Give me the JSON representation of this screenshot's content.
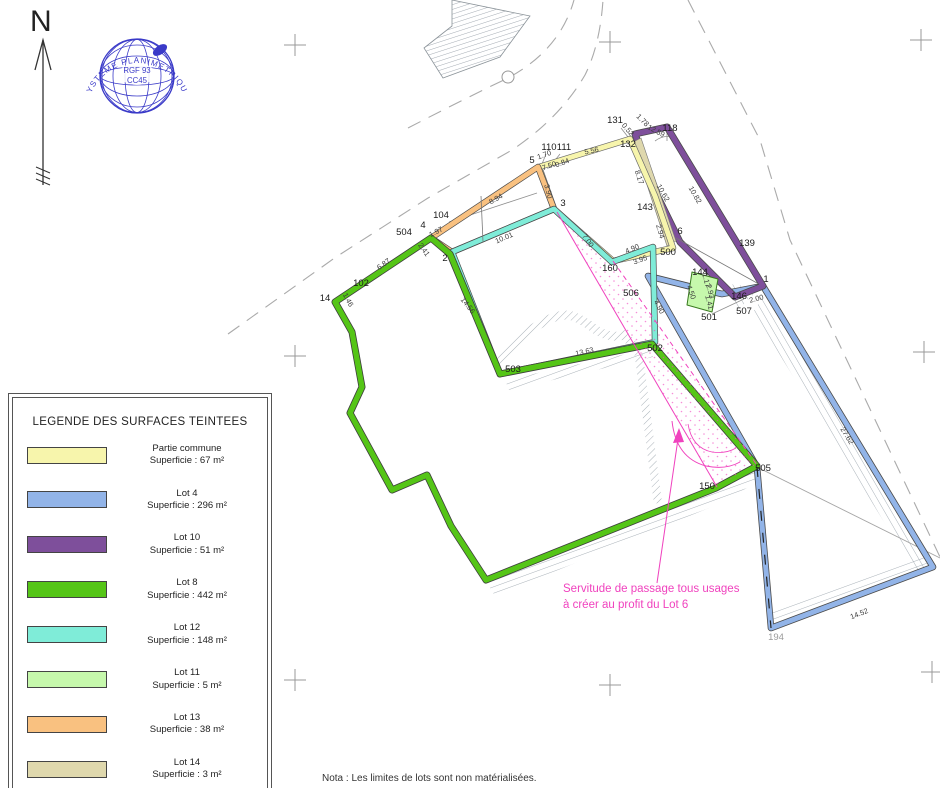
{
  "north": {
    "label": "N"
  },
  "stamp": {
    "arc_text": "SYSTEME PLANIMETRIQUE",
    "line1": "RGF 93",
    "line2": "CC45",
    "color": "#3A3AC8"
  },
  "legend": {
    "title": "LEGENDE DES SURFACES TEINTEES",
    "entries": [
      {
        "name": "Partie commune",
        "area": "Superficie : 67 m²",
        "color": "#F7F5AC"
      },
      {
        "name": "Lot 4",
        "area": "Superficie : 296 m²",
        "color": "#92B4E8"
      },
      {
        "name": "Lot 10",
        "area": "Superficie : 51 m²",
        "color": "#7E4F9B"
      },
      {
        "name": "Lot 8",
        "area": "Superficie : 442 m²",
        "color": "#55C517"
      },
      {
        "name": "Lot 12",
        "area": "Superficie : 148 m²",
        "color": "#7FECD8"
      },
      {
        "name": "Lot 11",
        "area": "Superficie : 5 m²",
        "color": "#C6F8AC"
      },
      {
        "name": "Lot 13",
        "area": "Superficie : 38 m²",
        "color": "#F9C180"
      },
      {
        "name": "Lot 14",
        "area": "Superficie : 3 m²",
        "color": "#DFD8AD"
      }
    ]
  },
  "servitude": {
    "line1": "Servitude de passage tous usages",
    "line2": "à créer au profit du Lot 6",
    "color": "#F042BE"
  },
  "nota": "Nota : Les limites de lots sont non matérialisées.",
  "map": {
    "point_labels": [
      {
        "t": "504",
        "x": 404,
        "y": 235
      },
      {
        "t": "4",
        "x": 423,
        "y": 228
      },
      {
        "t": "104",
        "x": 441,
        "y": 218
      },
      {
        "t": "102",
        "x": 361,
        "y": 286
      },
      {
        "t": "14",
        "x": 325,
        "y": 301
      },
      {
        "t": "2",
        "x": 445,
        "y": 261
      },
      {
        "t": "5",
        "x": 532,
        "y": 163
      },
      {
        "t": "110",
        "x": 549,
        "y": 150
      },
      {
        "t": "111",
        "x": 564,
        "y": 150
      },
      {
        "t": "3",
        "x": 563,
        "y": 206
      },
      {
        "t": "131",
        "x": 615,
        "y": 123
      },
      {
        "t": "132",
        "x": 628,
        "y": 147
      },
      {
        "t": "118",
        "x": 670,
        "y": 131
      },
      {
        "t": "143",
        "x": 645,
        "y": 210
      },
      {
        "t": "160",
        "x": 610,
        "y": 271
      },
      {
        "t": "6",
        "x": 680,
        "y": 234
      },
      {
        "t": "500",
        "x": 668,
        "y": 255
      },
      {
        "t": "139",
        "x": 747,
        "y": 246
      },
      {
        "t": "144",
        "x": 700,
        "y": 275
      },
      {
        "t": "146",
        "x": 739,
        "y": 299
      },
      {
        "t": "1",
        "x": 766,
        "y": 282
      },
      {
        "t": "506",
        "x": 631,
        "y": 296
      },
      {
        "t": "501",
        "x": 709,
        "y": 320
      },
      {
        "t": "507",
        "x": 744,
        "y": 314
      },
      {
        "t": "502",
        "x": 655,
        "y": 351
      },
      {
        "t": "503",
        "x": 513,
        "y": 372
      },
      {
        "t": "505",
        "x": 763,
        "y": 471
      },
      {
        "t": "150",
        "x": 707,
        "y": 489
      },
      {
        "t": "194",
        "x": 776,
        "y": 640,
        "gray": true
      }
    ],
    "dim_labels": [
      {
        "t": "8.94",
        "x": 497,
        "y": 201,
        "r": -29
      },
      {
        "t": "1.97",
        "x": 437,
        "y": 234,
        "r": -27
      },
      {
        "t": "10.01",
        "x": 505,
        "y": 240,
        "r": -23
      },
      {
        "t": "3.90",
        "x": 546,
        "y": 192,
        "r": 75
      },
      {
        "t": "1.70",
        "x": 545,
        "y": 157,
        "r": -20
      },
      {
        "t": "7.50",
        "x": 550,
        "y": 168,
        "r": -20
      },
      {
        "t": "0.84",
        "x": 563,
        "y": 165,
        "r": -20
      },
      {
        "t": "5.56",
        "x": 592,
        "y": 153,
        "r": -12
      },
      {
        "t": "0.52",
        "x": 626,
        "y": 131,
        "r": 50
      },
      {
        "t": "1.78",
        "x": 641,
        "y": 122,
        "r": 45
      },
      {
        "t": "12.59",
        "x": 655,
        "y": 133,
        "r": 28
      },
      {
        "t": "8.17",
        "x": 637,
        "y": 178,
        "r": 72
      },
      {
        "t": "10.62",
        "x": 661,
        "y": 194,
        "r": 60
      },
      {
        "t": "10.82",
        "x": 693,
        "y": 196,
        "r": 60
      },
      {
        "t": "2.94",
        "x": 658,
        "y": 232,
        "r": 74
      },
      {
        "t": "4.90",
        "x": 633,
        "y": 251,
        "r": -22
      },
      {
        "t": "3.95",
        "x": 641,
        "y": 262,
        "r": -20
      },
      {
        "t": "7.00",
        "x": 586,
        "y": 242,
        "r": 55
      },
      {
        "t": "4.90",
        "x": 657,
        "y": 308,
        "r": 62
      },
      {
        "t": "4.50",
        "x": 689,
        "y": 293,
        "r": 70
      },
      {
        "t": "1.17",
        "x": 704,
        "y": 281,
        "r": 75
      },
      {
        "t": "2.93",
        "x": 708,
        "y": 292,
        "r": 75
      },
      {
        "t": "1.41",
        "x": 707,
        "y": 303,
        "r": 75
      },
      {
        "t": "2.00",
        "x": 757,
        "y": 301,
        "r": -15
      },
      {
        "t": "13.63",
        "x": 585,
        "y": 354,
        "r": -13
      },
      {
        "t": "14.56",
        "x": 466,
        "y": 307,
        "r": 52
      },
      {
        "t": "6.87",
        "x": 385,
        "y": 266,
        "r": -36
      },
      {
        "t": "1.46",
        "x": 346,
        "y": 301,
        "r": 62
      },
      {
        "t": "2.41",
        "x": 422,
        "y": 251,
        "r": 55
      },
      {
        "t": "27.62",
        "x": 845,
        "y": 437,
        "r": 58
      },
      {
        "t": "14.52",
        "x": 860,
        "y": 616,
        "r": -21
      }
    ]
  }
}
